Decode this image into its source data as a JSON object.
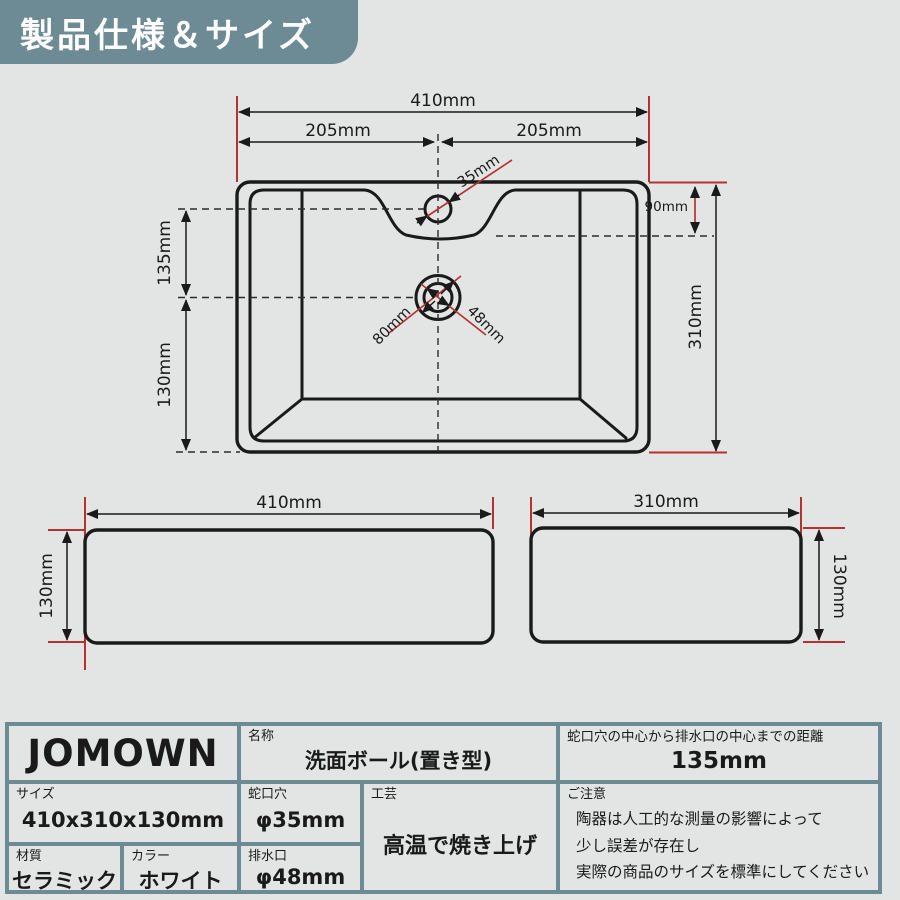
{
  "palette": {
    "background": "#e3e5e4",
    "slate": "#6d8b94",
    "red": "#b5332c",
    "ink": "#1a1a1a",
    "white_text": "#ffffff"
  },
  "header": {
    "title": "製品仕様＆サイズ"
  },
  "top_view": {
    "dim_width_total": "410mm",
    "dim_width_left": "205mm",
    "dim_width_right": "205mm",
    "dim_faucet_hole": "35mm",
    "dim_top_to_recess": "90mm",
    "dim_depth_total": "310mm",
    "dim_faucet_to_drain": "135mm",
    "dim_drain_to_front": "130mm",
    "dim_drain_flange": "80mm",
    "dim_drain_hole": "48mm"
  },
  "front_view": {
    "dim_width": "410mm",
    "dim_height": "130mm"
  },
  "side_view": {
    "dim_depth": "310mm",
    "dim_height": "130mm"
  },
  "spec_table": {
    "brand": "JOMOWN",
    "name_label": "名称",
    "name_value": "洗面ボール(置き型)",
    "distance_label": "蛇口穴の中心から排水口の中心までの距離",
    "distance_value": "135mm",
    "size_label": "サイズ",
    "size_value": "410x310x130mm",
    "faucet_label": "蛇口穴",
    "faucet_value": "φ35mm",
    "craft_label": "工芸",
    "craft_value": "高温で焼き上げ",
    "notice_label": "ご注意",
    "notice_line1": "陶器は人工的な測量の影響によって",
    "notice_line2": "少し誤差が存在し",
    "notice_line3": "実際の商品のサイズを標準にしてください",
    "material_label": "材質",
    "material_value": "セラミック",
    "color_label": "カラー",
    "color_value": "ホワイト",
    "drain_label": "排水口",
    "drain_value": "φ48mm"
  }
}
